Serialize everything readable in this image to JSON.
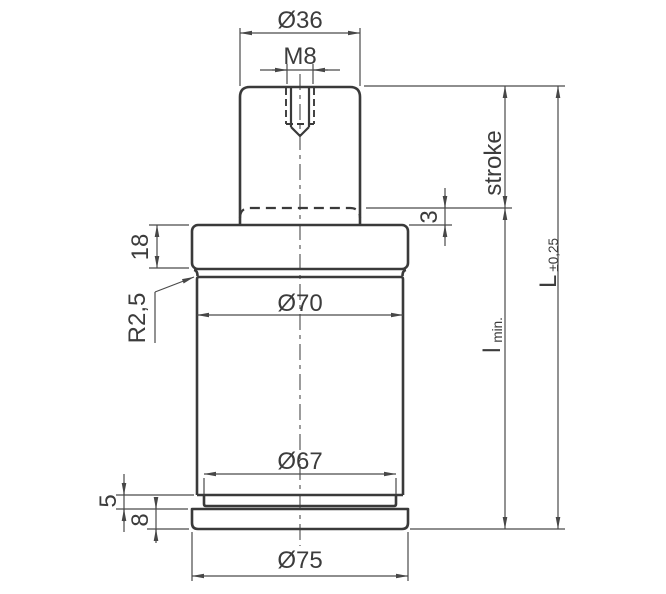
{
  "drawing": {
    "view": "gas-spring-dimension-drawing-side-view",
    "labels": {
      "rod_diameter": "Ø36",
      "thread": "M8",
      "stroke": "stroke",
      "clearance": "3",
      "head_height": "18",
      "fillet_radius": "R2,5",
      "body_diameter": "Ø70",
      "groove_diameter": "Ø67",
      "groove_height": "5",
      "base_height": "8",
      "base_diameter": "Ø75",
      "min_length_symbol": "l",
      "min_length_suffix": "min.",
      "total_length_symbol": "L",
      "total_length_tolerance": "±0,25"
    },
    "colors": {
      "background": "#ffffff",
      "outline": "#3a3a3a",
      "dimension_lines": "#4a4a4a",
      "text": "#3c3c3c"
    }
  }
}
